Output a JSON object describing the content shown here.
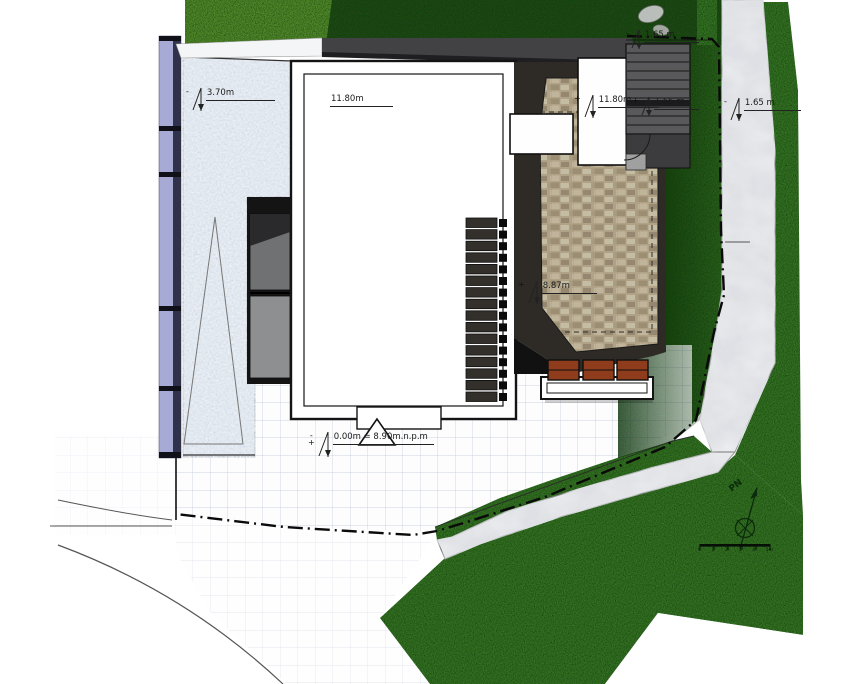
{
  "drawing": {
    "levels": [
      {
        "id": "terrace",
        "sign_top": "-",
        "sign_bottom": "",
        "text": "3.70m"
      },
      {
        "id": "building-width",
        "sign_top": "",
        "sign_bottom": "",
        "text": "11.80m"
      },
      {
        "id": "roof-east",
        "sign_top": "+",
        "sign_bottom": "",
        "text": "11.80m"
      },
      {
        "id": "stairs-top",
        "sign_top": "-",
        "sign_bottom": "",
        "text": "1.65 m"
      },
      {
        "id": "stairs-mid",
        "sign_top": "+",
        "sign_bottom": "",
        "text": "1.65 m"
      },
      {
        "id": "path-east",
        "sign_top": "-",
        "sign_bottom": "",
        "text": "1.65 m"
      },
      {
        "id": "patio",
        "sign_top": "+",
        "sign_bottom": "",
        "text": "8.87m"
      },
      {
        "id": "entrance",
        "sign_top": "-",
        "sign_bottom": "+",
        "text": "0.00m = 8.90m.n.p.m"
      }
    ],
    "north_arrow": {
      "label": "PN"
    },
    "scale_bar": {
      "labels": [
        "0",
        "1",
        "2",
        "3",
        "4",
        "5m"
      ]
    },
    "colors": {
      "grass": "#3f7d2b",
      "grass_dark": "#27481c",
      "grass_light": "#5f9a33",
      "terrace": "#cdd7e3",
      "wall": "#a6aad4",
      "stone": "#b0a286",
      "bench": "#8e3c1c",
      "roof": "#424244",
      "path": "#ebecee",
      "grid": "#cdd3e0"
    }
  }
}
